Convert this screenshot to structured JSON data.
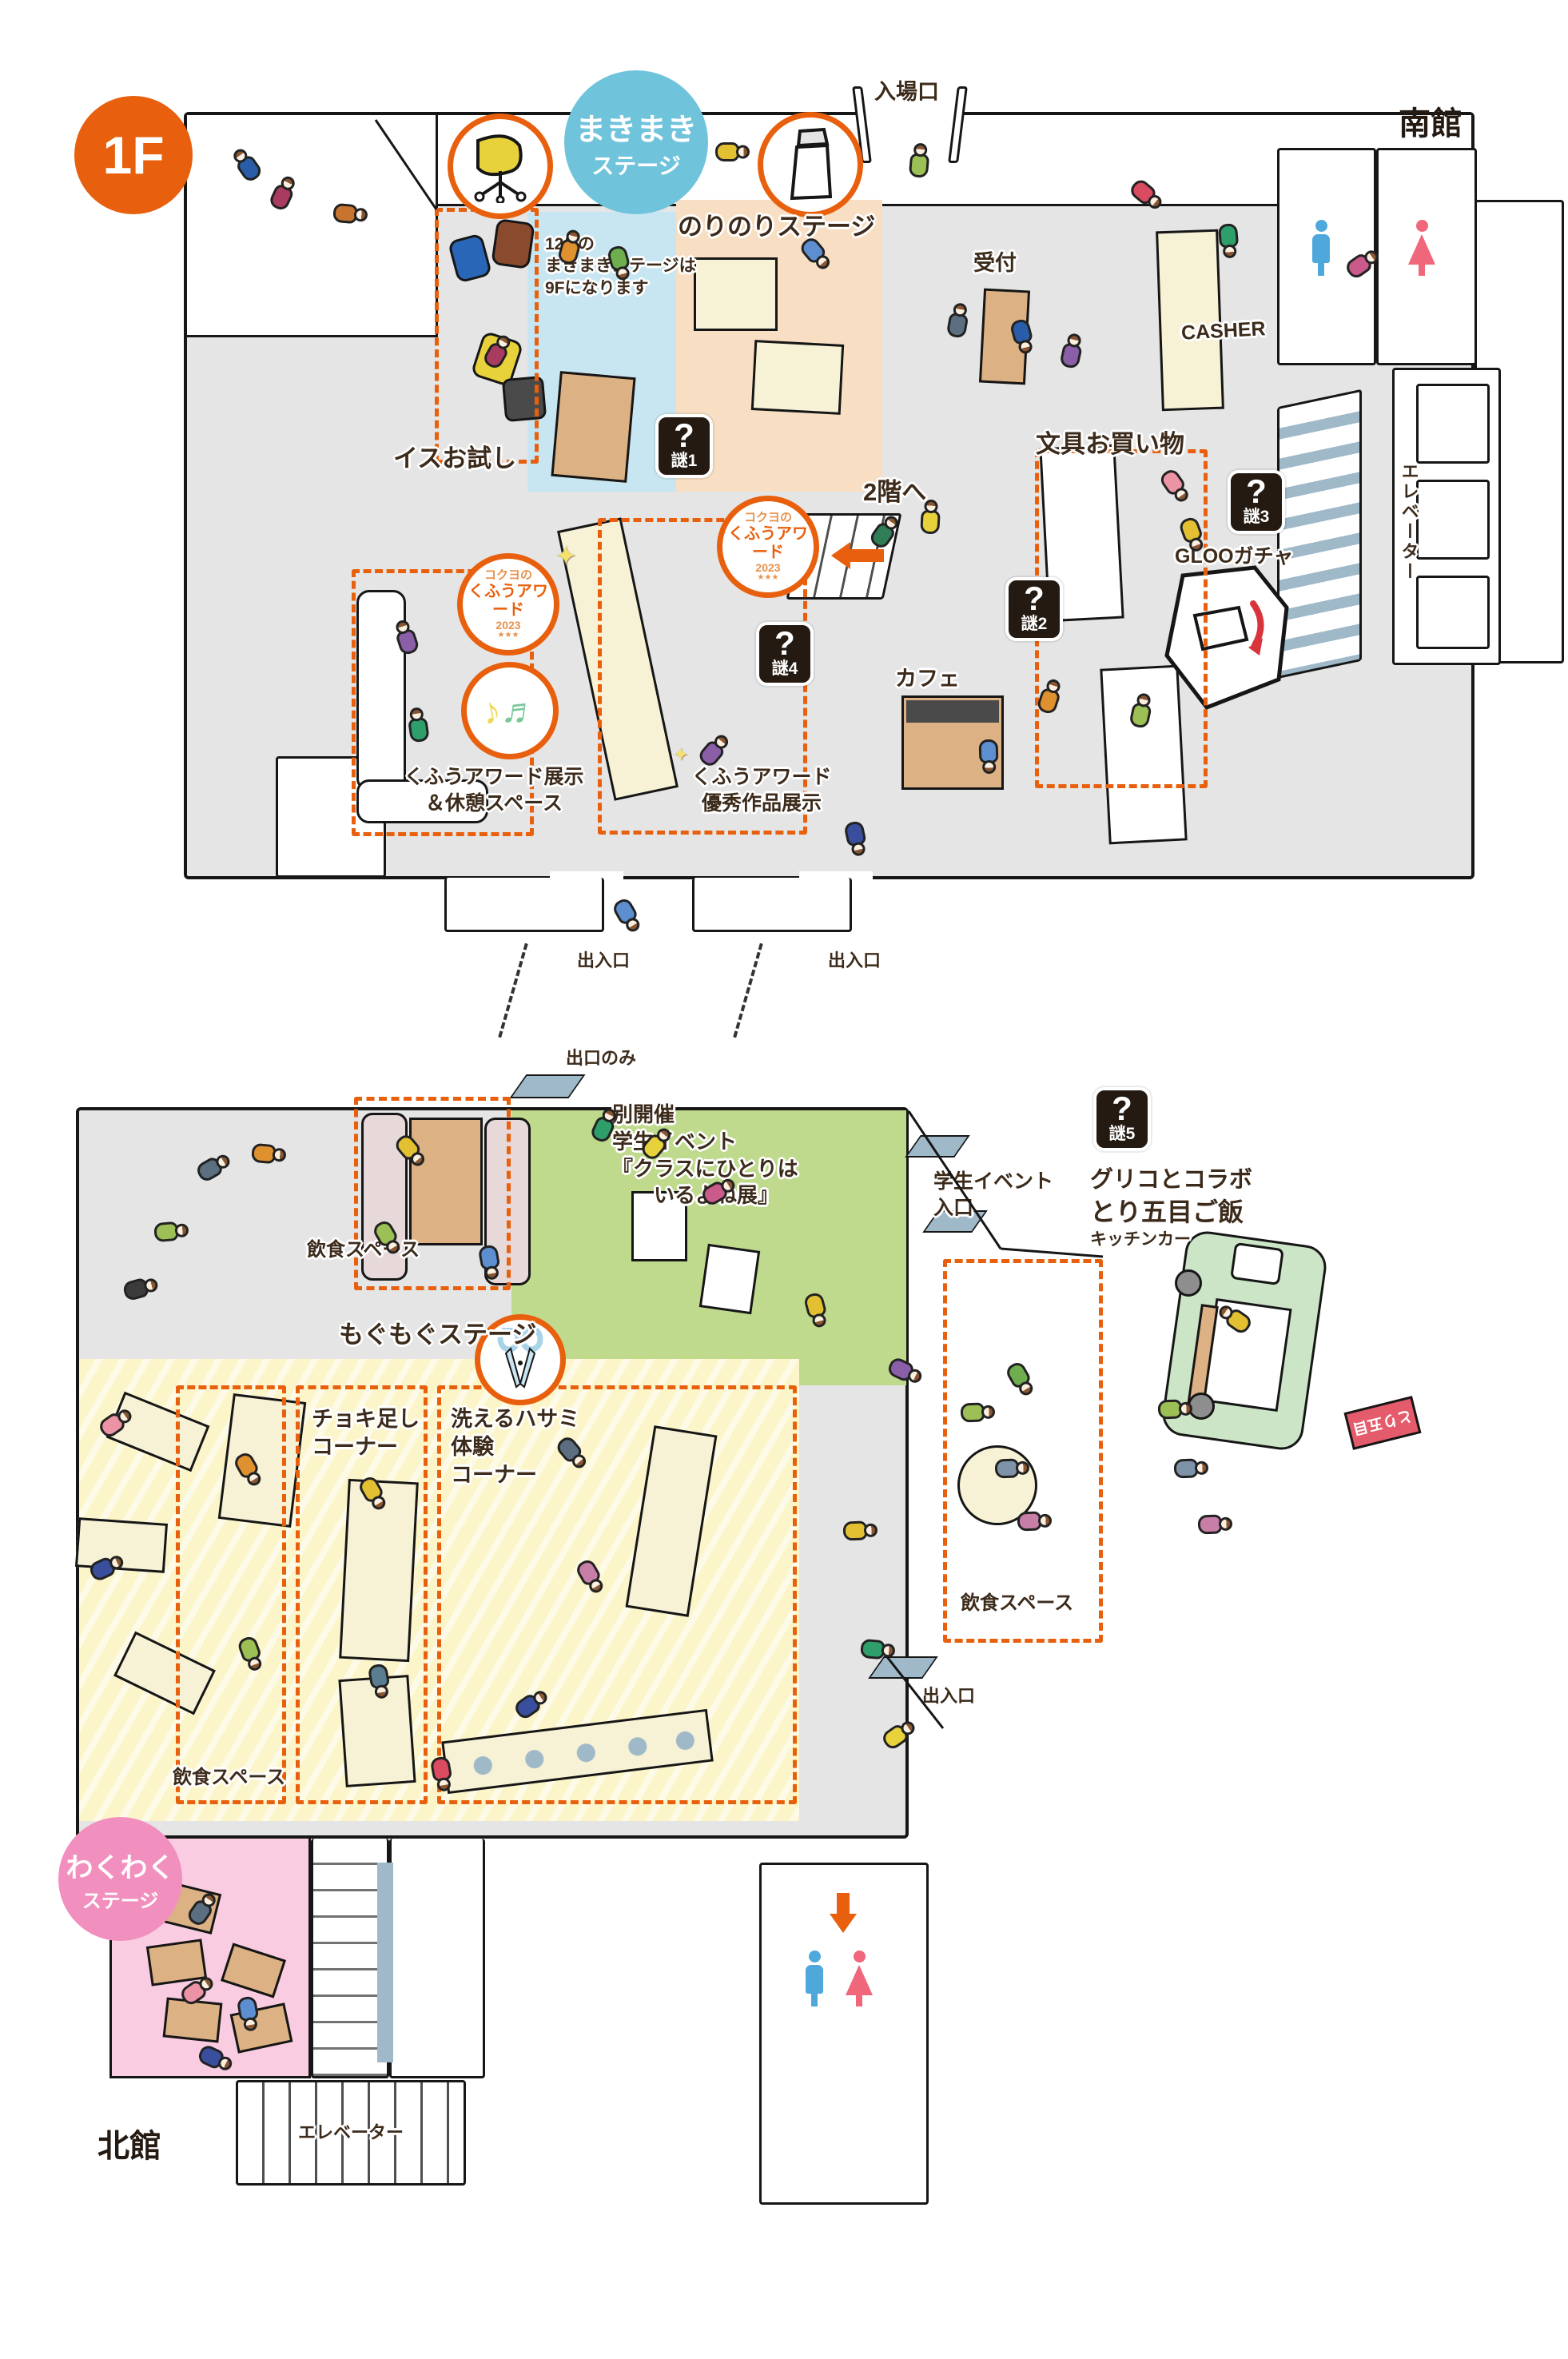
{
  "floor_badge": "1F",
  "buildings": {
    "south": "南館",
    "north": "北館"
  },
  "colors": {
    "accent_orange": "#E8600D",
    "teal": "#6FC3DB",
    "pink_badge": "#F190BE",
    "black_badge": "#241A12",
    "floor_gray": "#E5E5E5",
    "blue_room": "#C8E6F2",
    "peach_room": "#F8DFC3",
    "green_zone": "#BFDA8D",
    "yellow_zone": "#FCF5C9",
    "pink_zone": "#F9CCE1",
    "wc_blue": "#4FA8DC",
    "wc_red": "#F0667A"
  },
  "south": {
    "entrance": "入場口",
    "makimaki": {
      "l1": "まきまき",
      "l2": "ステージ",
      "n1": "12/2の",
      "n2": "まきまきステージは",
      "n3": "9Fになります"
    },
    "norinori": "のりのりステージ",
    "chair_trial": "イスお試し",
    "reception": "受付",
    "casher": "CASHER",
    "stationery": "文具お買い物",
    "gloo": "GLOOガチャ",
    "elevator": "エレベーター",
    "to2f": "2階へ",
    "cafe": "カフェ",
    "award_ex1": "くふうアワード展示",
    "award_ex2": "＆休憩スペース",
    "award_best1": "くふうアワード",
    "award_best2": "優秀作品展示",
    "exit_left": "出入口",
    "exit_right": "出入口",
    "nazo1": {
      "q": "?",
      "label": "謎1"
    },
    "nazo2": {
      "q": "?",
      "label": "謎2"
    },
    "nazo3": {
      "q": "?",
      "label": "謎3"
    },
    "nazo4": {
      "q": "?",
      "label": "謎4"
    },
    "award_badge": {
      "brand": "コクヨの",
      "title": "くふうアワード",
      "year": "2023",
      "stars": "★★★"
    }
  },
  "north": {
    "exit_only": "出口のみ",
    "dining_top": "飲食スペース",
    "dining_left": "飲食スペース",
    "dining_right": "飲食スペース",
    "event": {
      "l1": "別開催",
      "l2": "学生イベント",
      "l3": "『クラスにひとりは",
      "l4": "いるよね展』",
      "in1": "学生イベント",
      "in2": "入口"
    },
    "mogumogu": "もぐもぐステージ",
    "choki1": "チョキ足し",
    "choki2": "コーナー",
    "hasami1": "洗えるハサミ",
    "hasami2": "体験",
    "hasami3": "コーナー",
    "nazo5": {
      "q": "?",
      "label": "謎5"
    },
    "glico": {
      "l1": "グリコとコラボ",
      "l2": "とり五目ご飯",
      "l3": "キッチンカー",
      "flag": "とり五目"
    },
    "wakuwaku": {
      "l1": "わくわく",
      "l2": "ステージ"
    },
    "exit": "出入口",
    "elevator": "エレベーター"
  }
}
